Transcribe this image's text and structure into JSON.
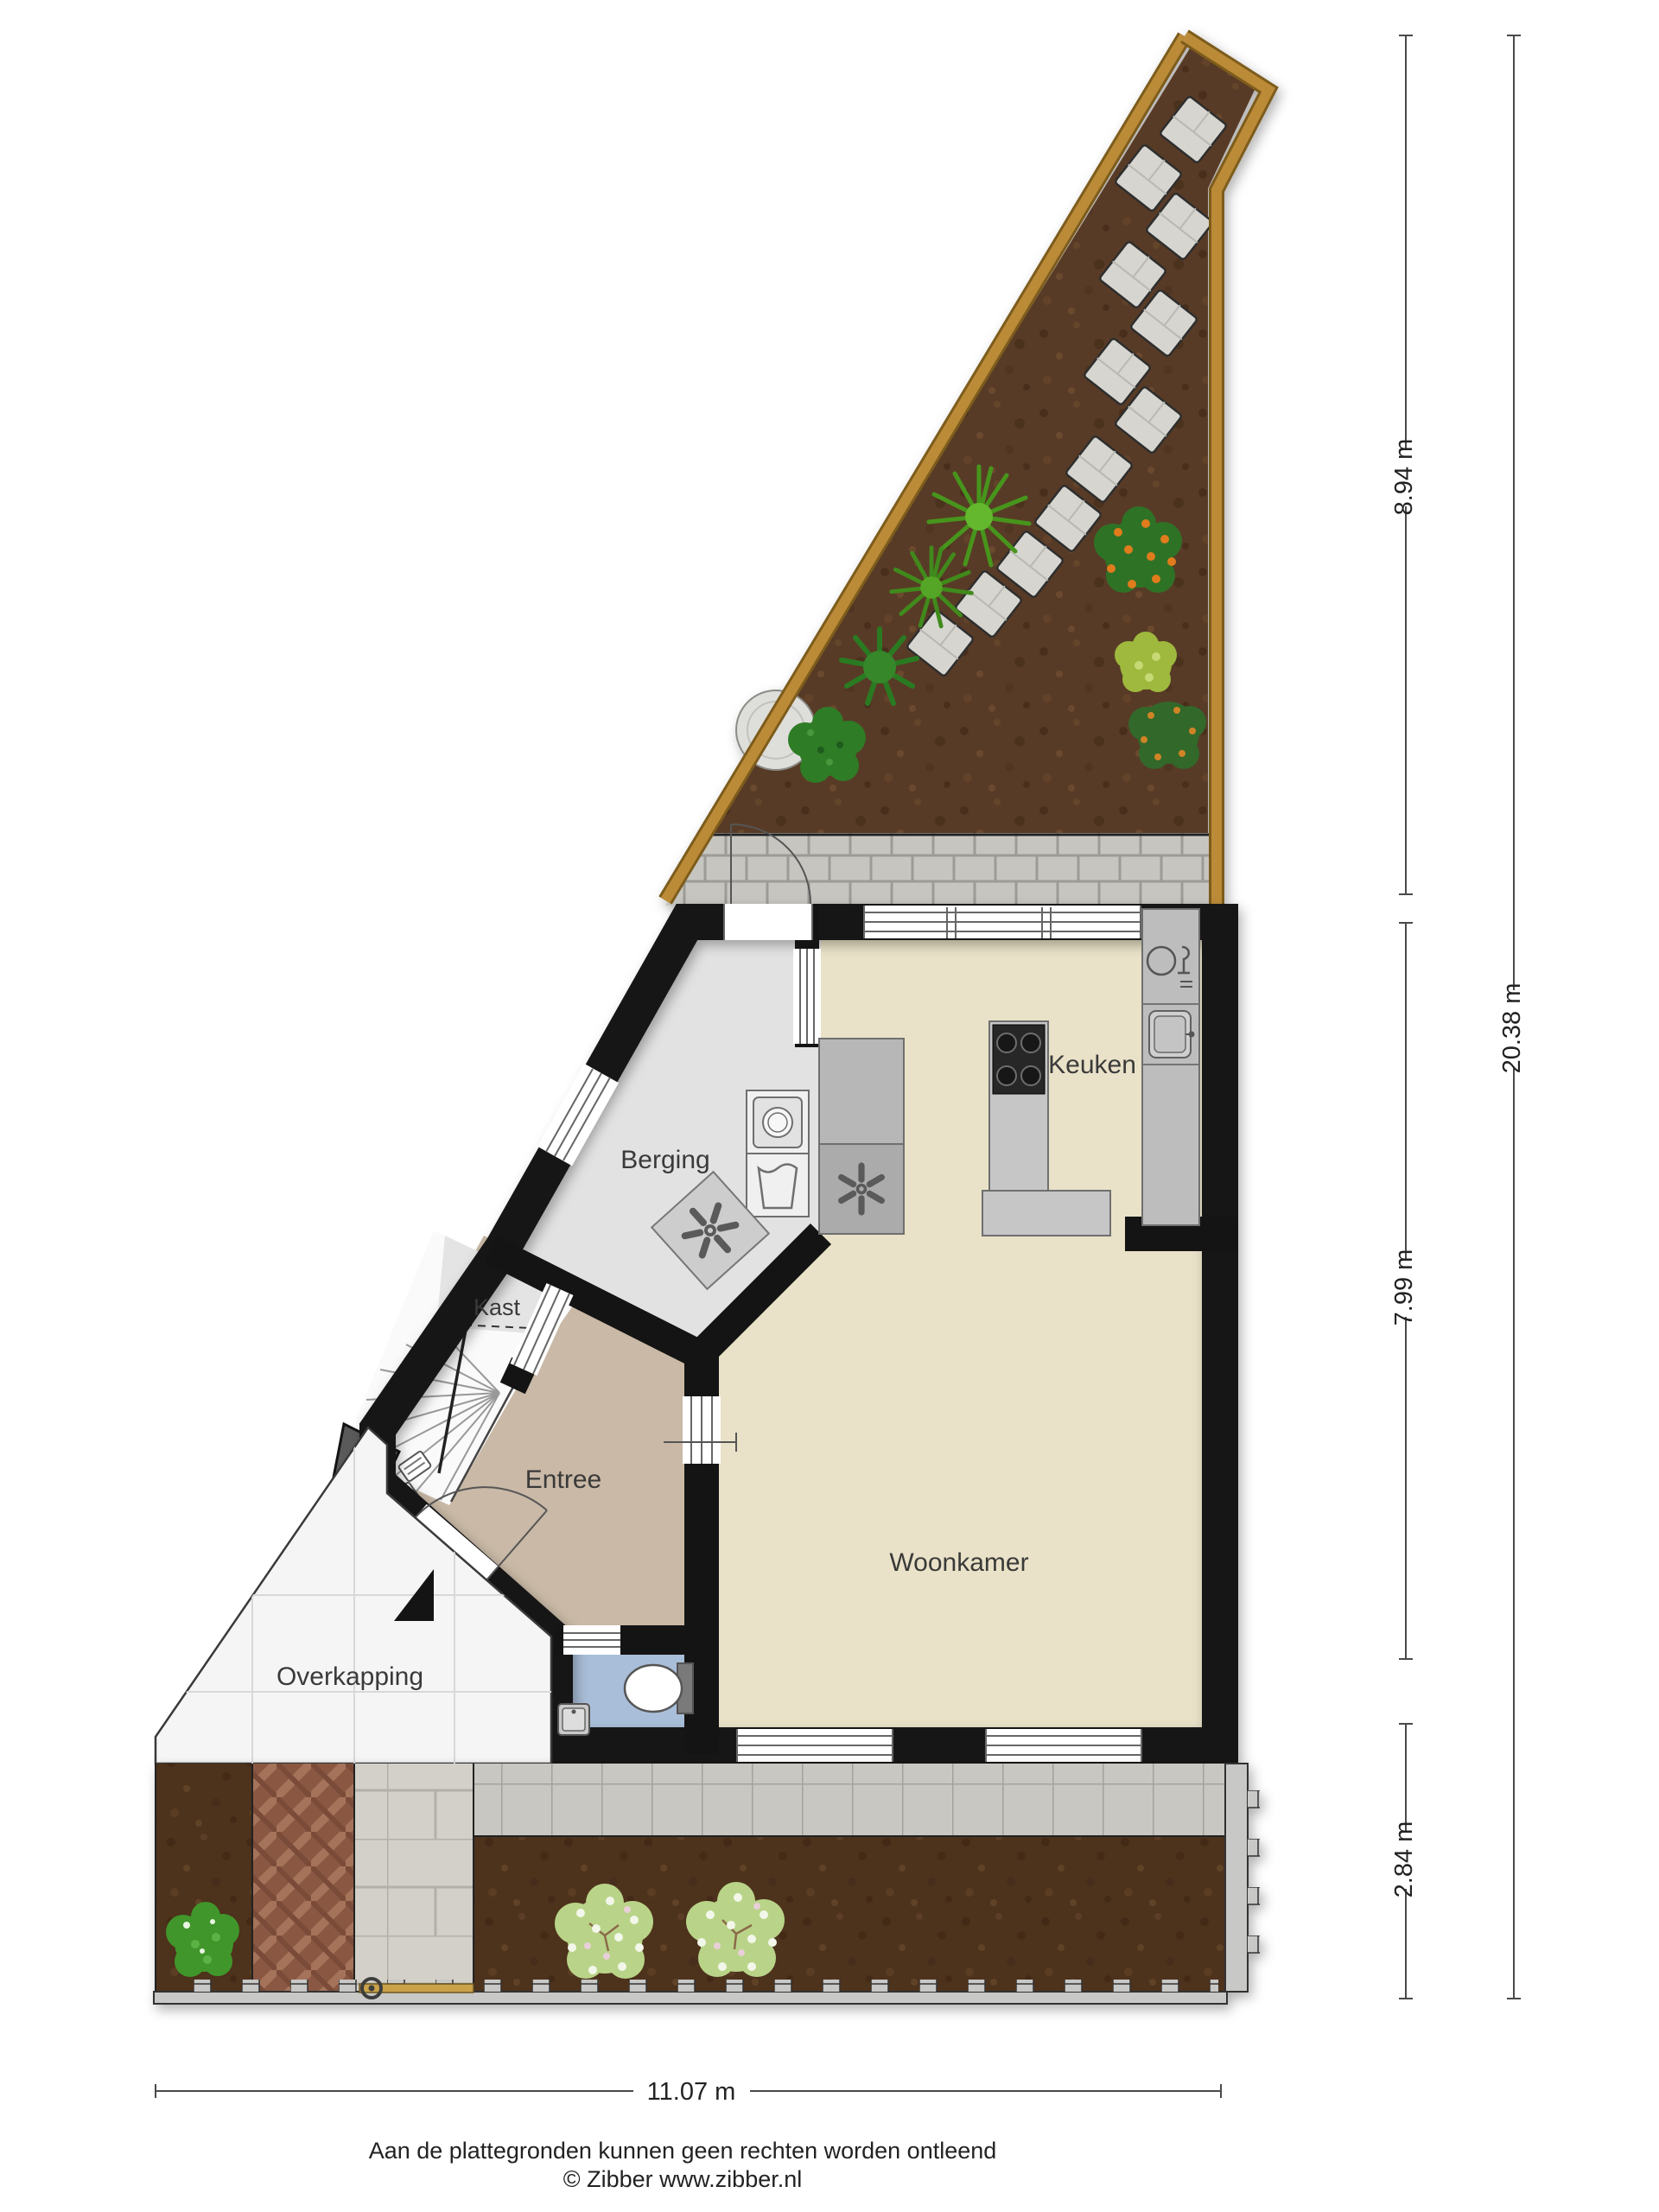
{
  "plan": {
    "rooms": {
      "berging": "Berging",
      "keuken": "Keuken",
      "kast": "Kast",
      "entree": "Entree",
      "woonkamer": "Woonkamer",
      "overkapping": "Overkapping"
    },
    "dimensions": {
      "garden_top_height": "8.94 m",
      "total_height": "20.38 m",
      "house_height": "7.99 m",
      "garden_bottom_height": "2.84 m",
      "plot_width": "11.07 m"
    },
    "footer": {
      "disclaimer": "Aan de plattegronden kunnen geen rechten worden ontleend",
      "copyright": "© Zibber www.zibber.nl"
    },
    "colors": {
      "wall": "#141414",
      "floor_living": "#e9e2c8",
      "floor_storage": "#e2e2e2",
      "floor_hall": "#c9b9a6",
      "floor_toilet": "#a9bed8",
      "floor_canopy": "#f5f5f5",
      "soil_top": "#583a26",
      "soil_bottom": "#4e331f",
      "fence_wood": "#bb8b39",
      "paving_light": "#d2d0c9",
      "paving_terrace": "#c9c7c1",
      "brick_path": "#8f5f48",
      "counter_gray": "#bdbdbd",
      "dimension_line": "#4a4a4a",
      "label_text": "#3a3a3a"
    }
  }
}
